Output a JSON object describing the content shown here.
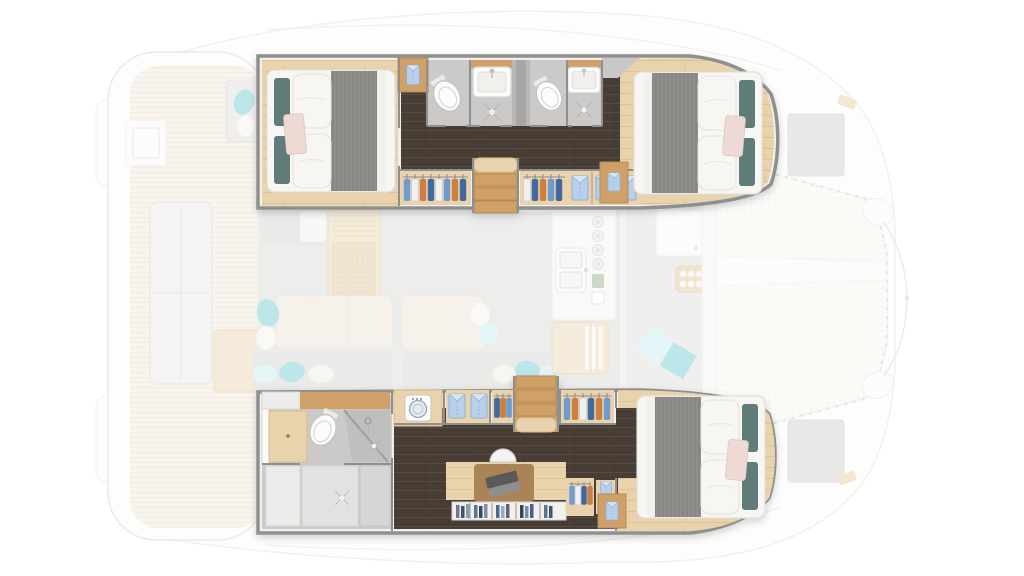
{
  "meta": {
    "title": "Catamaran yacht floor plan — 3-cabin owner's layout, lower deck highlighted",
    "image_type": "top-down yacht layout rendering",
    "orientation": {
      "bow": "right",
      "stern": "left"
    },
    "rendering_note": "Lower-deck hull interiors drawn opaque; main deck, cockpits, foredeck and trampoline drawn faded"
  },
  "colors": {
    "hull_wall": "#8f8f8f",
    "wall_fill": "#f1f0ee",
    "wood_light": "#e9d3ac",
    "wood_grain": "#dec296",
    "wood_mid": "#cfa167",
    "wood_dark": "#aa8457",
    "dark_floor": "#473d34",
    "dark_grain": "#584c41",
    "tile": "#cbcac8",
    "tile_dark": "#c0bfbd",
    "fixture": "#fcfcfb",
    "bed_white": "#f7f6f3",
    "duvet": "#8f8e8b",
    "duvet_stripe": "#81807d",
    "pillow_teal": "#5e7b79",
    "pillow_blush": "#eddad4",
    "accent_blue": "#6f9bcd",
    "accent_blue_dark": "#41699f",
    "accent_orange": "#cc7f42",
    "shirt_blue": "#b9d0ea",
    "teal_bright": "#7fd2d8",
    "teal_soft": "#cdeef0",
    "deck_wood": "#f3ece0",
    "deck_stripe": "#e7dcc8",
    "saloon_floor": "#dedddb",
    "saloon_gray": "#d8d7d5",
    "sofa_beige": "#efe8d9",
    "table_wood": "#ecd9ba",
    "tramp": "#faf9f6",
    "tramp_line": "#edeae3",
    "outline": "#e8e6e2"
  },
  "inventory": {
    "port_hull_top": {
      "label": "Port hull (top, shown opaque)",
      "rooms": [
        {
          "name": "aft guest cabin",
          "furniture": [
            "double bed with gray duvet",
            "white pillows",
            "teal accent pillows",
            "blush throw pillow",
            "nightstand with folded shirt"
          ]
        },
        {
          "name": "aft guest bathroom",
          "fixtures": [
            "toilet",
            "washbasin",
            "shower with drain"
          ]
        },
        {
          "name": "technical compartment between bathrooms"
        },
        {
          "name": "forward guest bathroom",
          "fixtures": [
            "toilet",
            "washbasin",
            "shower with drain"
          ]
        },
        {
          "name": "corridor with dark wood sole"
        },
        {
          "name": "wardrobes",
          "contents": [
            "hanging clothes on hangers",
            "three folded blue shirts on shelves"
          ]
        },
        {
          "name": "companionway stairs to saloon"
        },
        {
          "name": "forward guest cabin",
          "furniture": [
            "double bed with gray duvet",
            "white pillows",
            "teal accent pillows",
            "blush throw pillow",
            "nightstand"
          ]
        }
      ]
    },
    "starboard_hull_bottom": {
      "label": "Starboard hull (bottom, owner's suite, shown opaque)",
      "rooms": [
        {
          "name": "owner's bathroom aft",
          "fixtures": [
            "vanity with mirror",
            "toilet",
            "glass shower",
            "shower drain",
            "dressing area"
          ]
        },
        {
          "name": "laundry cabinet",
          "fixtures": [
            "washing machine"
          ]
        },
        {
          "name": "office / dressing area",
          "furniture": [
            "desk",
            "office chair",
            "laptop",
            "bookshelf with books",
            "wardrobes with hangers",
            "shelves with folded shirts"
          ]
        },
        {
          "name": "companionway stairs to saloon"
        },
        {
          "name": "owner's forward cabin",
          "furniture": [
            "double bed with gray duvet",
            "white pillows",
            "teal accent pillows",
            "blush throw pillow",
            "nightstand with folded shirt"
          ]
        }
      ]
    },
    "main_deck_faded": {
      "label": "Main deck (shown faded)",
      "areas": [
        {
          "name": "aft cockpit",
          "furniture": [
            "transom bench",
            "seat with teal cushions",
            "cockpit table",
            "helm console"
          ]
        },
        {
          "name": "swim platforms"
        },
        {
          "name": "saloon",
          "furniture": [
            "nav seat",
            "rattan dining table",
            "L-sofa",
            "chaise benches",
            "teal and white scatter cushions"
          ]
        },
        {
          "name": "galley",
          "fixtures": [
            "aft counter",
            "double sink with faucet",
            "four stove burners",
            "island cabinet with louvered doors"
          ]
        },
        {
          "name": "forward cockpit",
          "furniture": [
            "seat locker",
            "cup-holder tray",
            "two teal cushions"
          ]
        },
        {
          "name": "trampoline with central walkway and lacing"
        },
        {
          "name": "foredeck hatches",
          "count": 2
        },
        {
          "name": "bow bridle lines"
        }
      ]
    },
    "counts": {
      "cabins": 3,
      "double_beds": 3,
      "bathrooms": 3,
      "toilets": 3,
      "showers": 3,
      "companionway_stairs": 2,
      "washing_machines": 1
    }
  }
}
